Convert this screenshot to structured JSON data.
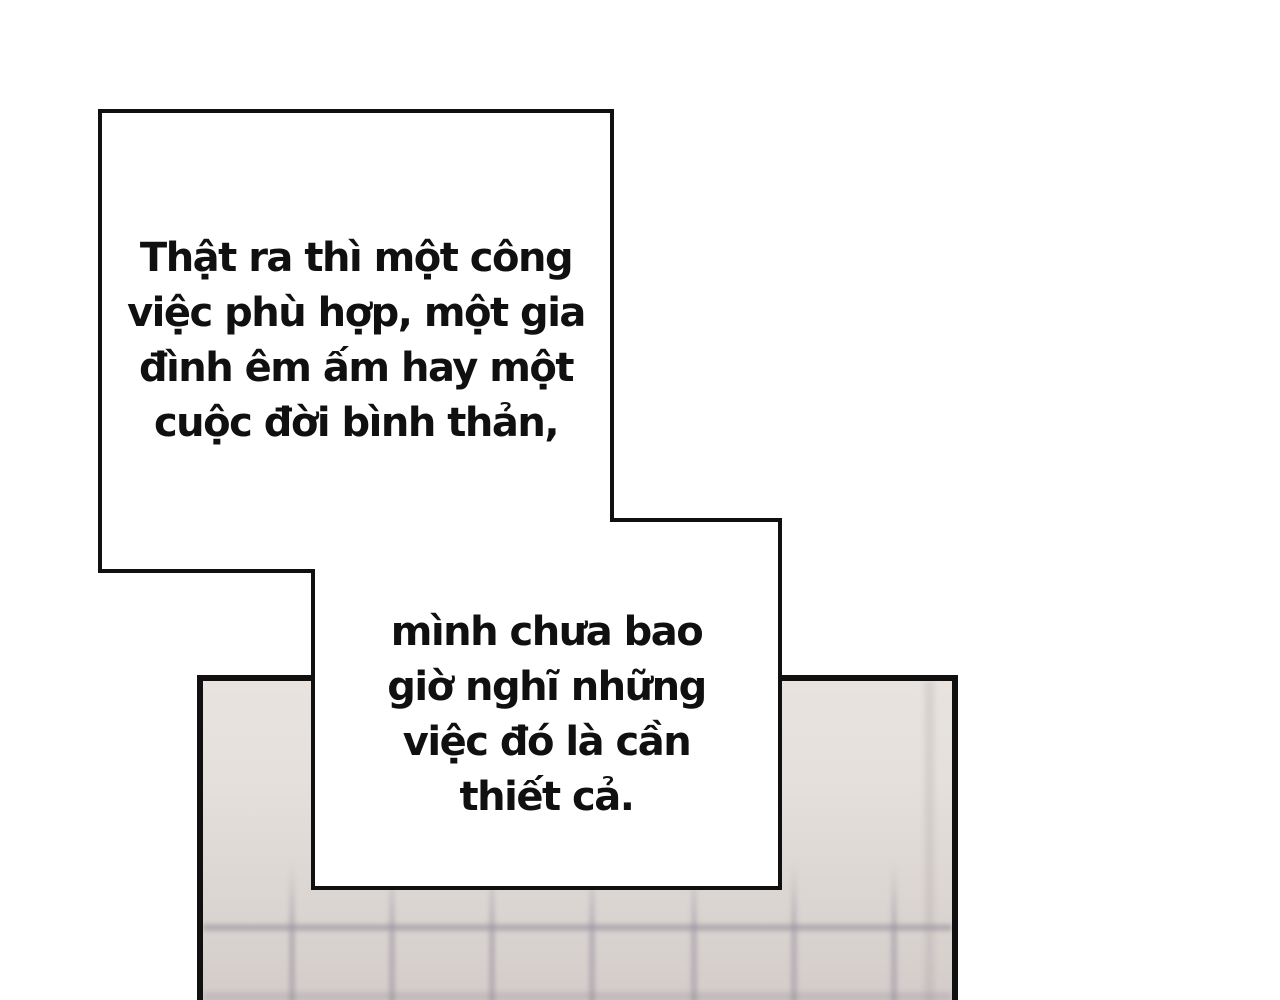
{
  "comic": {
    "bubble1": {
      "lines": [
        "Thật ra thì một công",
        "việc phù hợp, một gia",
        "đình êm ấm hay một",
        "cuộc đời bình thản,"
      ]
    },
    "bubble2": {
      "lines": [
        "mình chưa bao",
        "giờ nghĩ những",
        "việc đó là cần",
        "thiết cả."
      ]
    }
  },
  "colors": {
    "ink": "#101010",
    "bubble_fill": "#ffffff",
    "page_bg": "#ffffff",
    "panel_top": "#e8e3df",
    "panel_mid": "#ddd7d4",
    "panel_bottom": "#d2cbc9",
    "grid_line": "#9b93a0"
  }
}
